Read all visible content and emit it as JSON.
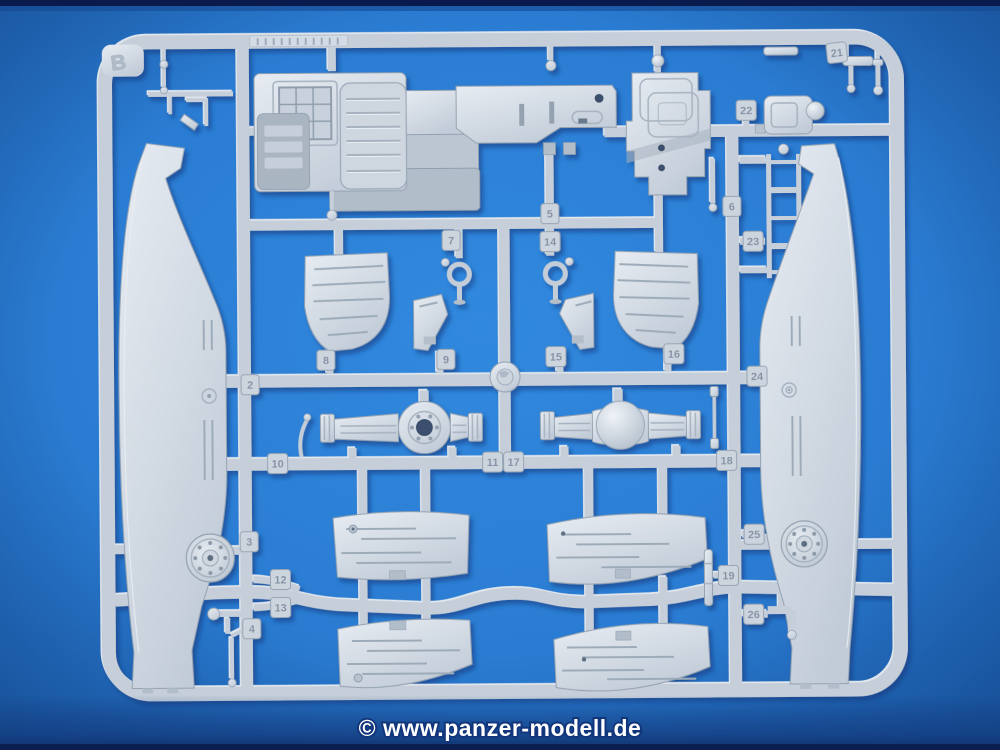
{
  "sprue": {
    "letter": "B"
  },
  "watermark": {
    "text": "© www.panzer-modell.de"
  },
  "tags": [
    {
      "label": "2"
    },
    {
      "label": "3"
    },
    {
      "label": "4"
    },
    {
      "label": "5"
    },
    {
      "label": "6"
    },
    {
      "label": "7"
    },
    {
      "label": "8"
    },
    {
      "label": "9"
    },
    {
      "label": "10"
    },
    {
      "label": "11"
    },
    {
      "label": "17"
    },
    {
      "label": "12"
    },
    {
      "label": "13"
    },
    {
      "label": "14"
    },
    {
      "label": "15"
    },
    {
      "label": "16"
    },
    {
      "label": "18"
    },
    {
      "label": "19"
    },
    {
      "label": "21"
    },
    {
      "label": "22"
    },
    {
      "label": "23"
    },
    {
      "label": "24"
    },
    {
      "label": "25"
    },
    {
      "label": "26"
    }
  ],
  "colors": {
    "background_blue": "#2a7cd2",
    "background_dark": "#123a7d",
    "plastic_light": "#e7ecf2",
    "plastic_base": "#c5ced9",
    "plastic_shadow": "#94a2b2",
    "watermark_fill": "#ffffff",
    "watermark_outline": "#12367c"
  }
}
